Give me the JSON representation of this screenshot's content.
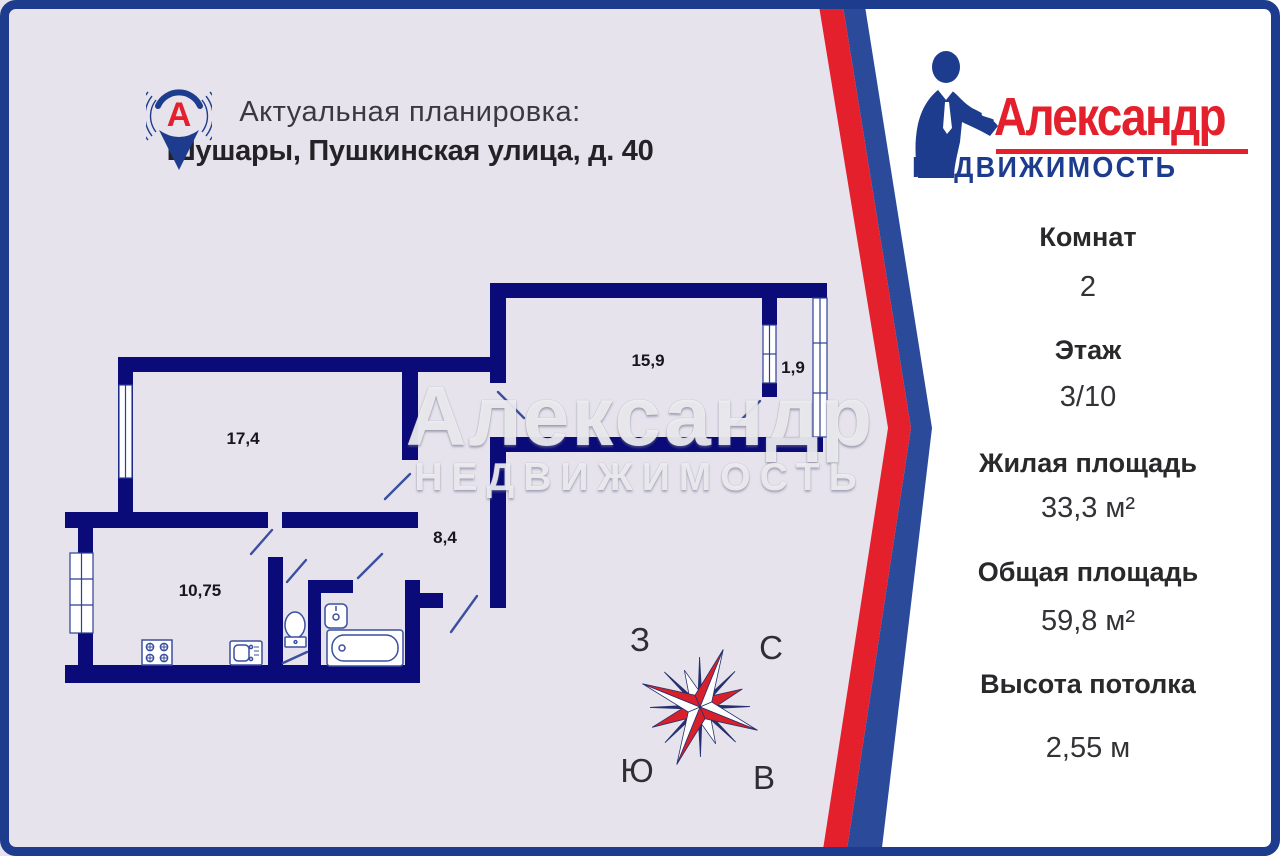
{
  "header": {
    "title": "Актуальная планировка:",
    "address": "Шушары, Пушкинская улица, д. 40"
  },
  "brand": {
    "name": "Александр",
    "tagline": "НЕДВИЖИМОСТЬ"
  },
  "watermark": {
    "name": "Александр",
    "tagline": "НЕДВИЖИМОСТЬ"
  },
  "floor_plan": {
    "rooms": [
      {
        "name": "living-room",
        "area": "17,4"
      },
      {
        "name": "bedroom",
        "area": "15,9"
      },
      {
        "name": "balcony",
        "area": "1,9"
      },
      {
        "name": "hallway",
        "area": "8,4"
      },
      {
        "name": "kitchen",
        "area": "10,75"
      }
    ]
  },
  "compass": {
    "west": "З",
    "north": "С",
    "south": "Ю",
    "east": "В"
  },
  "details": [
    {
      "label": "Комнат",
      "value": "2"
    },
    {
      "label": "Этаж",
      "value": "3/10"
    },
    {
      "label": "Жилая площадь",
      "value": "33,3 м²"
    },
    {
      "label": "Общая площадь",
      "value": "59,8 м²"
    },
    {
      "label": "Высота потолка",
      "value": "2,55 м"
    }
  ],
  "colors": {
    "accent_red": "#e3202b",
    "brand_navy": "#1e3c8e",
    "stripe_navy": "#2c4a9a",
    "wall_navy": "#0a0a78",
    "panel_lavender": "#e6e3ec"
  }
}
